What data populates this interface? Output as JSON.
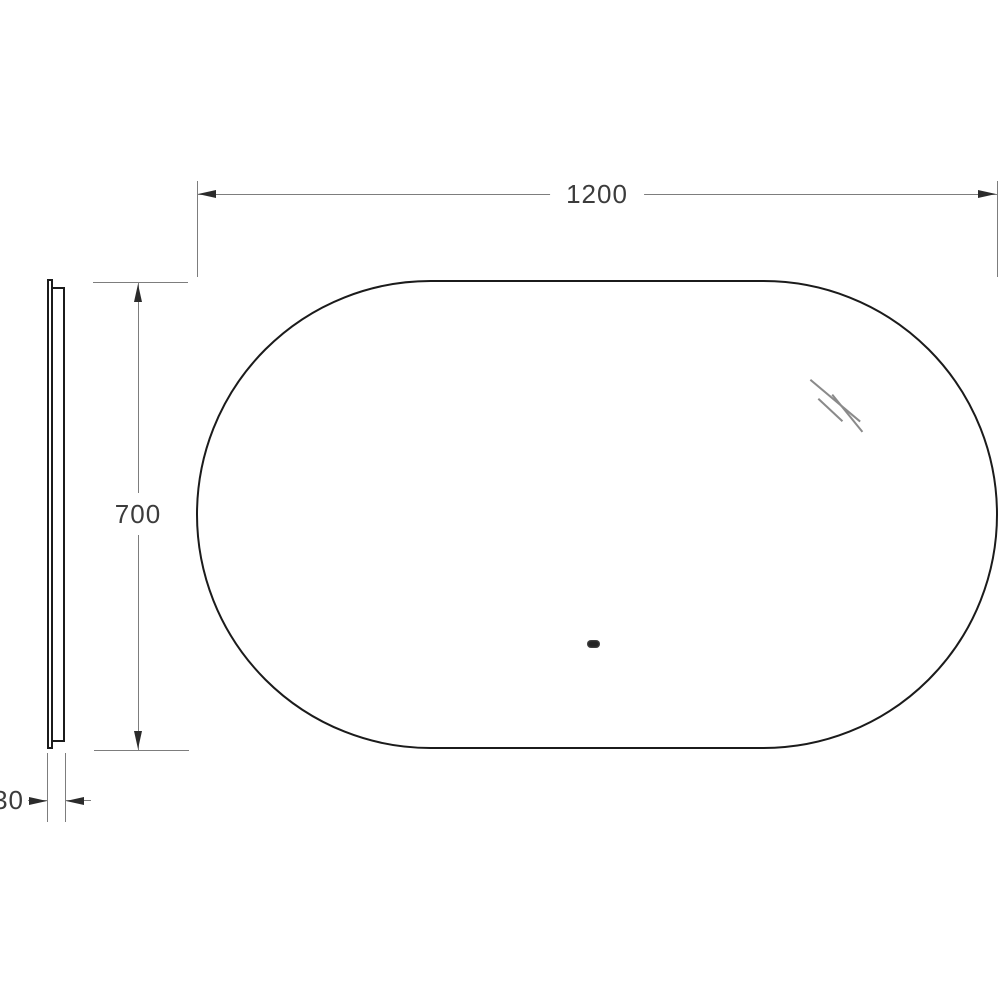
{
  "drawing": {
    "type": "mirror technical drawing, front view and side profile",
    "dimensions": {
      "width": "1200",
      "height": "700",
      "depth": "30"
    },
    "colors": {
      "background": "#ffffff",
      "outline": "#1b1b1b",
      "dimension_line": "#7d7d7d",
      "arrowhead": "#2b2b2b",
      "text": "#3c3c3c",
      "glare": "#8a8a8a",
      "sensor": "#242424"
    }
  }
}
